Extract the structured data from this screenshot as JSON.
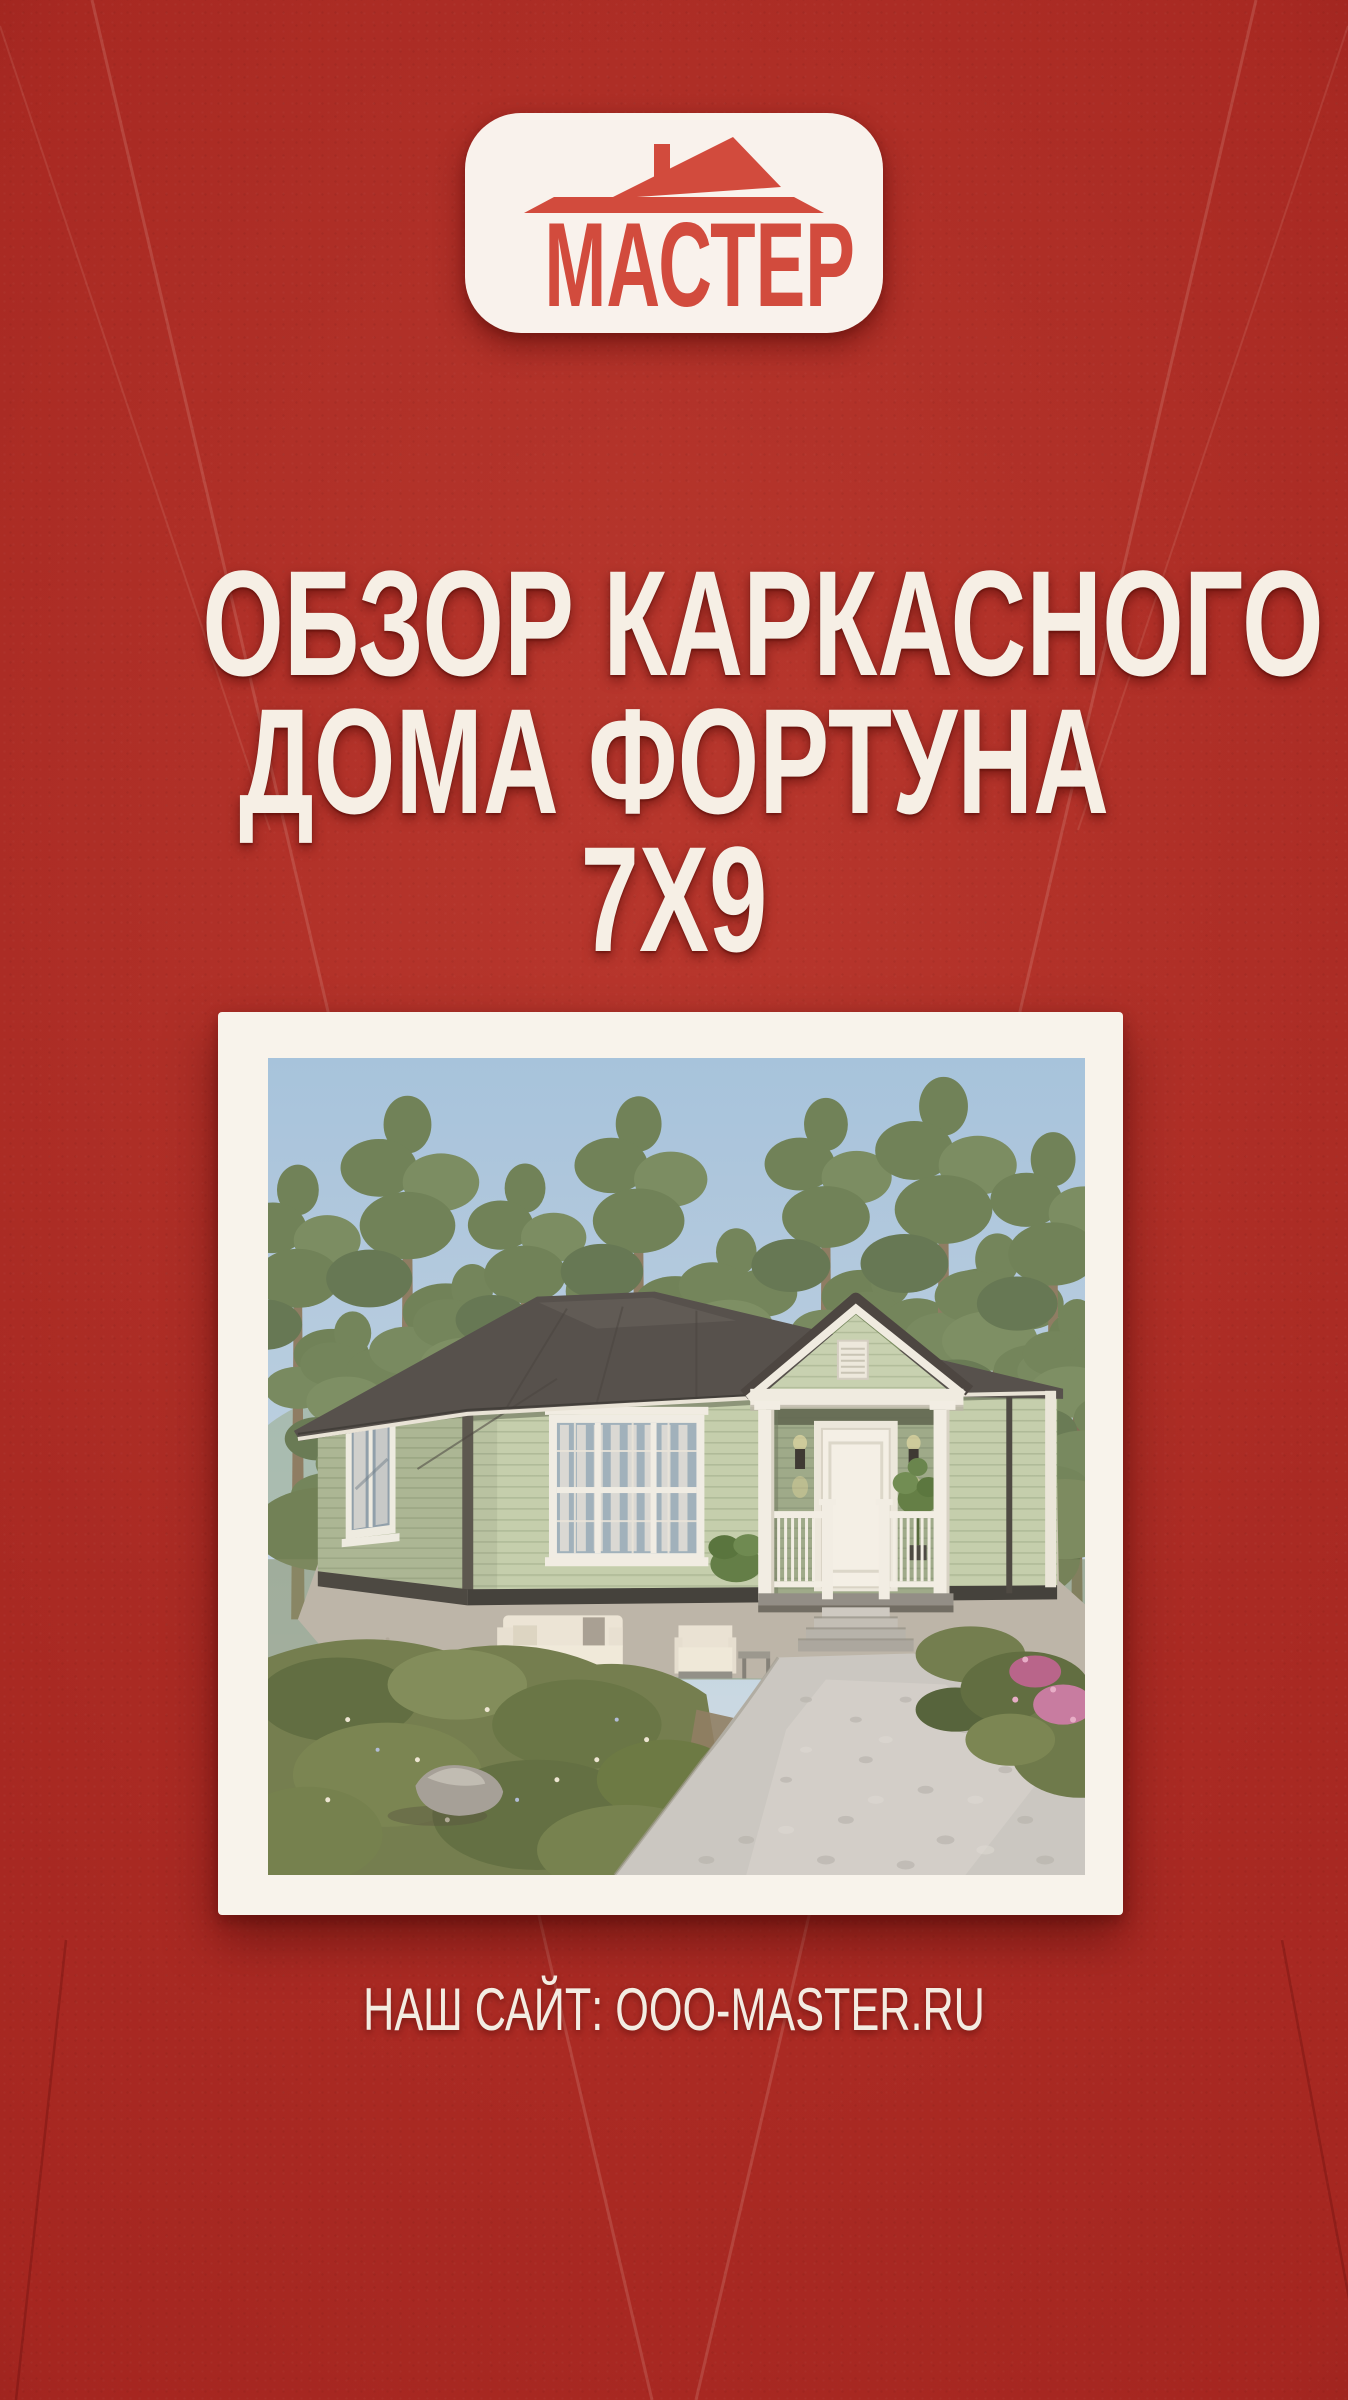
{
  "poster": {
    "background_color": "#a52620",
    "brand": {
      "name": "МАСТЕР",
      "logo_icon": "house-roof-icon",
      "accent_color": "#d24b3d",
      "card_color": "#f9f2ec"
    },
    "title": {
      "lines": [
        "ОБЗОР КАРКАСНОГО",
        "ДОМА ФОРТУНА",
        "7Х9"
      ],
      "color": "#f6efe5"
    },
    "photo": {
      "frame_color": "#f8f3eb"
    },
    "footer": {
      "site_label": "НАШ САЙТ: OOO-MASTER.RU",
      "color": "#f3ece2"
    }
  }
}
